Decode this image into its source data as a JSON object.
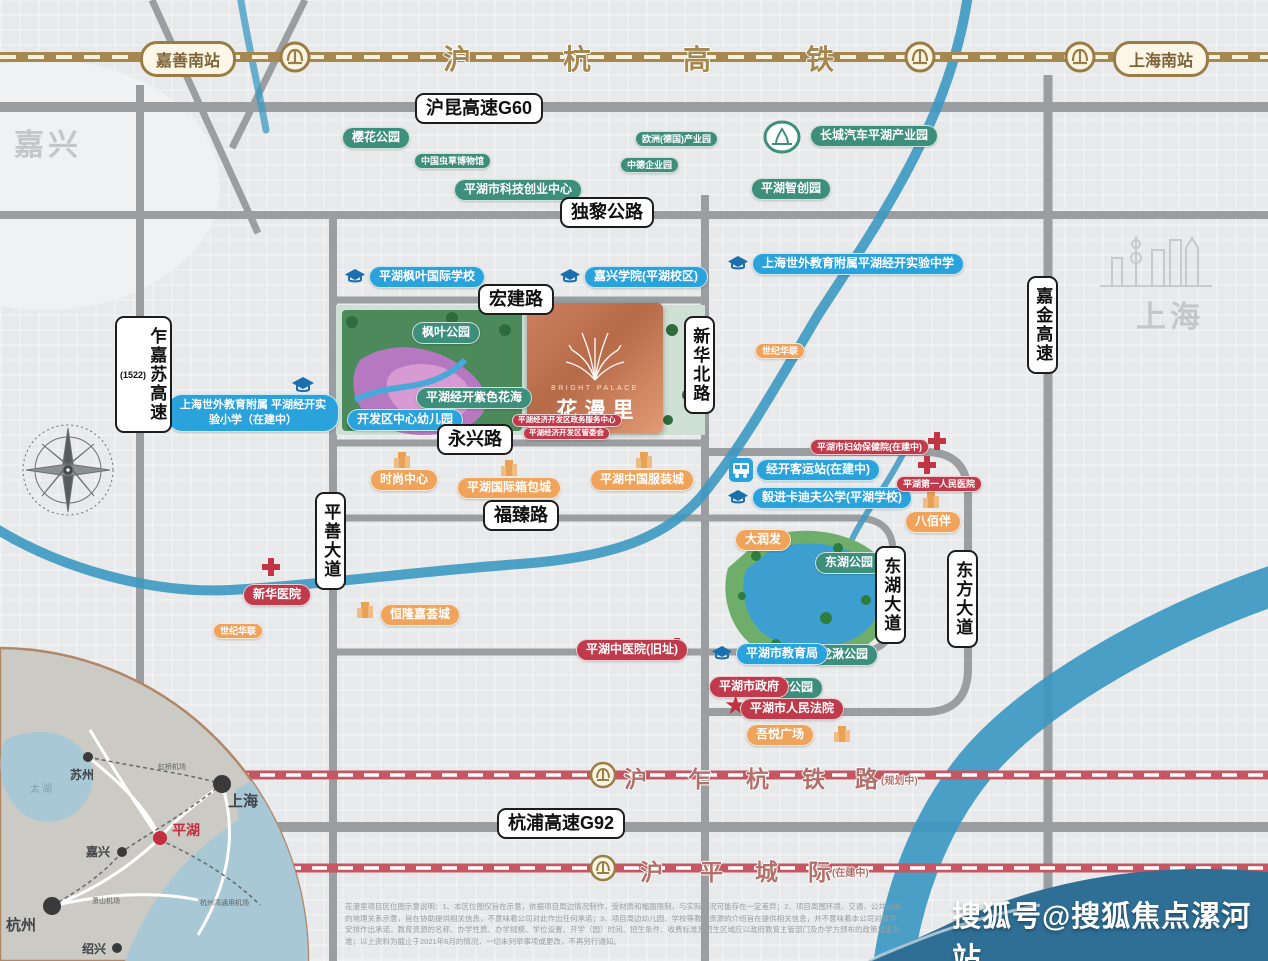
{
  "colors": {
    "road_gray": "#9b9ea0",
    "river_blue": "#3c98c2",
    "rail_gold": "#a5874f",
    "rail_red": "#c65661",
    "pill_green": "#3e8e7c",
    "pill_blue": "#2aa2dc",
    "pill_orange": "#f0a35a",
    "pill_red": "#c13a4b",
    "plate_copper": "#c87e5e",
    "wave_blue": "#2f6f95"
  },
  "city_labels": {
    "jiaxing": "嘉兴",
    "shanghai": "上海"
  },
  "rails": {
    "huhang": {
      "chars": [
        "沪",
        "杭",
        "高",
        "铁"
      ],
      "station_left": "嘉善南站",
      "station_right": "上海南站"
    },
    "r1": {
      "chars": [
        "沪",
        "乍",
        "杭",
        "铁",
        "路"
      ],
      "status": "(规划中)"
    },
    "r2": {
      "chars": [
        "沪",
        "平",
        "城",
        "际"
      ],
      "status": "(在建中)"
    }
  },
  "road_signs": {
    "g60": "沪昆高速G60",
    "duli": "独黎公路",
    "hongjian": "宏建路",
    "yongxing": "永兴路",
    "fuzhen": "福臻路",
    "g92": "杭浦高速G92",
    "zhajiasu": "乍嘉苏高速",
    "zhajiasu_code": "(1522)",
    "pingshan": "平善大道",
    "xinhuabei": "新华北路",
    "donghu_ave": "东湖大道",
    "dongfang_ave": "东方大道",
    "jiajin": "嘉金高速"
  },
  "pois": {
    "green": {
      "yinghua": "樱花公园",
      "chongcao": "中国虫草博物馆",
      "ouzhou": "欧洲(德国)产业园",
      "zhongde": "中德企业园",
      "keji": "平湖市科技创业中心",
      "changcheng": "长城汽车平湖产业园",
      "zhichuang": "平湖智创园",
      "fengye_park": "枫叶公园",
      "zise": "平湖经开紫色花海",
      "donghu_park": "东湖公园",
      "longqiu": "龙湫公园",
      "danghu": "当湖公园"
    },
    "blue": {
      "fengye_school": "平湖枫叶国际学校",
      "jiaxing_college": "嘉兴学院(平湖校区)",
      "shiwai_middle": "上海世外教育附属平湖经开实验中学",
      "shiwai_primary": "上海世外教育附属 平湖经开实验小学（在建中）",
      "youeryuan": "开发区中心幼儿园",
      "keyun": "经开客运站(在建中)",
      "cardiff": "毅进卡迪夫公学(平湖学校)",
      "jiaoyuju": "平湖市教育局"
    },
    "orange": {
      "shiji_e": "世纪华联",
      "shiji_w": "世纪华联",
      "shishang": "时尚中心",
      "xiangbao": "平湖国际箱包城",
      "fuzhuang": "平湖中国服装城",
      "babaiban": "八佰伴",
      "darunfa": "大润发",
      "henglong": "恒隆嘉荟城",
      "wuyue": "吾悦广场"
    },
    "red": {
      "xinhua_hospital": "新华医院",
      "fuyou": "平湖市妇幼保健院(在建中)",
      "diyi": "平湖第一人民医院",
      "zhongyi": "平湖中医院(旧址)",
      "zhengfu": "平湖市政府",
      "fayuan": "平湖市人民法院",
      "zhengwu": "平湖经济开发区政务服务中心",
      "guanweihui": "平湖经济开发区管委会"
    }
  },
  "project": {
    "name_en": "BRIGHT PALACE",
    "name_cn": "花漫里"
  },
  "compass": {
    "n": "N",
    "e": "E",
    "s": "S",
    "w": "W"
  },
  "inset": {
    "cities": {
      "suzhou": "苏州",
      "shanghai": "上海",
      "jiaxing": "嘉兴",
      "hangzhou": "杭州",
      "shaoxing": "绍兴",
      "pinghu": "平湖"
    },
    "lake": "太湖",
    "airports": {
      "hongqiao": "虹桥机场",
      "xiaoshan": "萧山机场",
      "tongyong": "杭州湾通用机场"
    }
  },
  "watermark": "搜狐号@搜狐焦点漯河站",
  "disclaimer": "花漫里项目区位图示意说明：1、本区位图仅旨在示意，依据项目周边情况制作，受材质和幅面限制，与实际情况可能存在一定差异；2、项目周围环境、交通、公共设施的地理关系示意，旨在协助提供相关信息，不意味着公司对此作出任何承诺；3、项目周边幼儿园、学校等教育资源的介绍旨在提供相关信息，并不意味着本公司对就学安排作出承诺，教育资源的名称、办学性质、办学规模、学位设置、开学（园）时间、招生条件、收费标准及招生区域应以政府教育主管部门及办学方颁布的政策规定为准；以上资料为截止于2021年6月的情况，一切未列举事项或更改，不再另行通知。"
}
